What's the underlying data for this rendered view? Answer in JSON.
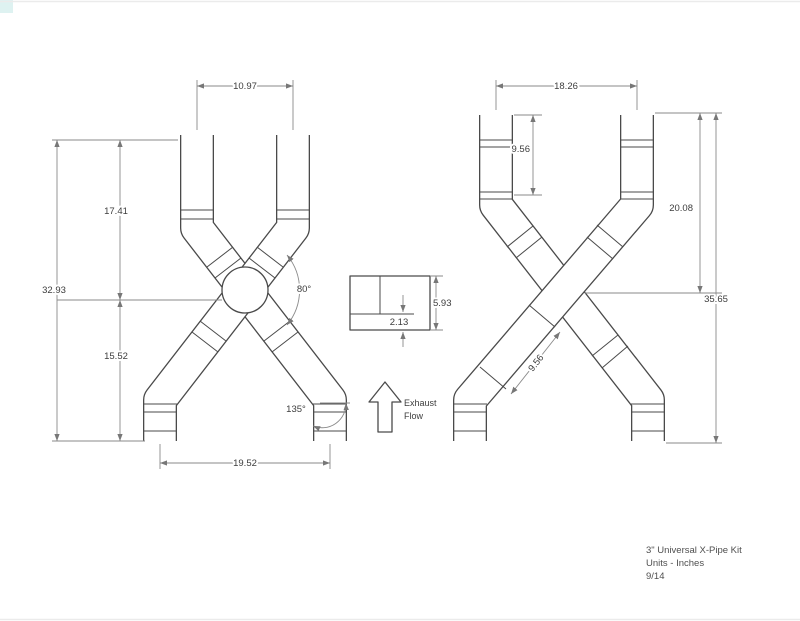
{
  "drawing": {
    "left_figure": {
      "top_width": "10.97",
      "upper_height": "17.41",
      "overall_height": "32.93",
      "lower_height": "15.52",
      "merge_angle": "80°",
      "bottom_width": "19.52",
      "bend_angle": "135°"
    },
    "detail_section": {
      "overall_height": "5.93",
      "offset": "2.13"
    },
    "flow_label": {
      "line1": "Exhaust",
      "line2": "Flow"
    },
    "right_figure": {
      "top_width": "18.26",
      "inlet_length": "9.56",
      "upper_height": "20.08",
      "overall_height": "35.65",
      "slip_section_length": "9.56"
    },
    "title_block": {
      "product": "3\" Universal X-Pipe Kit",
      "units": "Units - Inches",
      "revision": "9/14"
    },
    "colors": {
      "pipe_line": "#4a4a4a",
      "dimension_line": "#8a8a8a",
      "corner_accent": "#def2f1"
    }
  }
}
